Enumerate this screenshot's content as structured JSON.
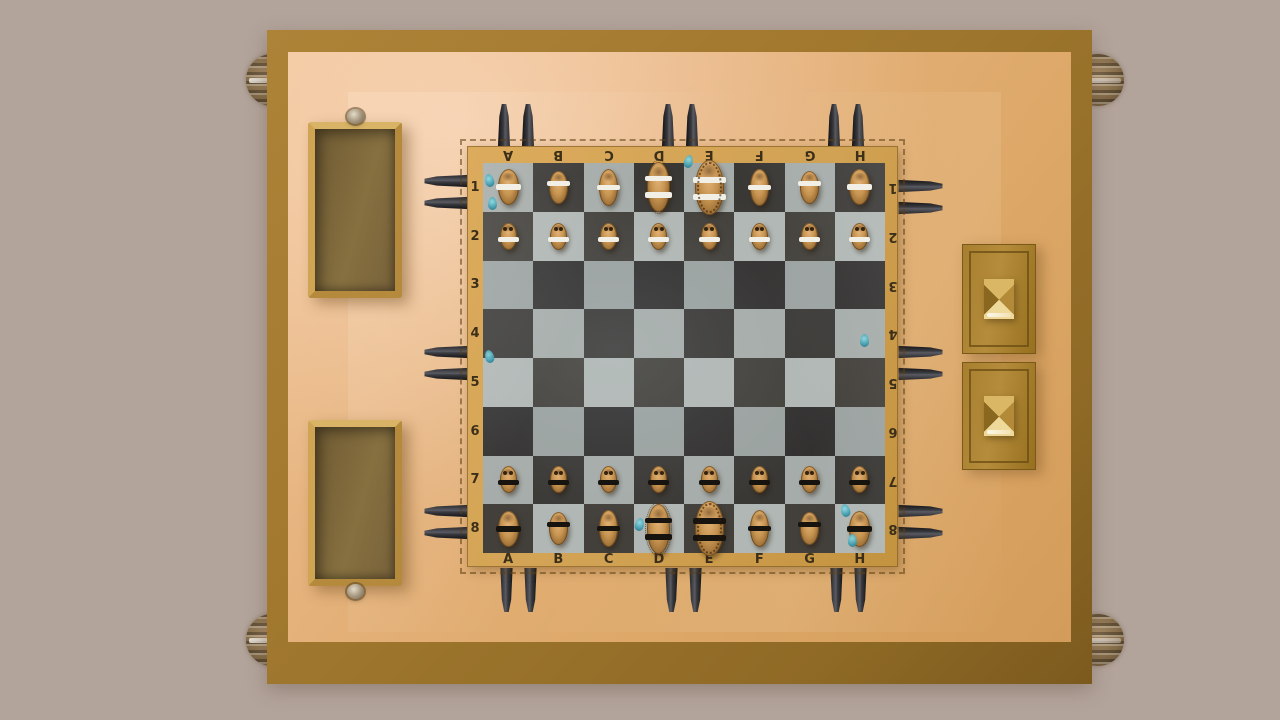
{
  "scene": {
    "background_color": "#b3a49b",
    "table_border_color": "#a1782e",
    "table_surface_color": "#dda868"
  },
  "board": {
    "files": [
      "A",
      "B",
      "C",
      "D",
      "E",
      "F",
      "G",
      "H"
    ],
    "ranks": [
      "1",
      "2",
      "3",
      "4",
      "5",
      "6",
      "7",
      "8"
    ],
    "frame_color": "#d2a254",
    "light_square_color": "#a6aca9",
    "dark_square_color": "#3a3835",
    "label_color": "#3c2f1a"
  },
  "pieces": {
    "wood_color": "#c79551",
    "white_band_color": "#f2efe6",
    "black_band_color": "#17130e",
    "setup": [
      {
        "square": "A1",
        "type": "rook",
        "color": "white"
      },
      {
        "square": "B1",
        "type": "knight",
        "color": "white"
      },
      {
        "square": "C1",
        "type": "bishop",
        "color": "white"
      },
      {
        "square": "D1",
        "type": "queen",
        "color": "white"
      },
      {
        "square": "E1",
        "type": "king",
        "color": "white"
      },
      {
        "square": "F1",
        "type": "bishop",
        "color": "white"
      },
      {
        "square": "G1",
        "type": "knight",
        "color": "white"
      },
      {
        "square": "H1",
        "type": "rook",
        "color": "white"
      },
      {
        "square": "A2",
        "type": "pawn",
        "color": "white"
      },
      {
        "square": "B2",
        "type": "pawn",
        "color": "white"
      },
      {
        "square": "C2",
        "type": "pawn",
        "color": "white"
      },
      {
        "square": "D2",
        "type": "pawn",
        "color": "white"
      },
      {
        "square": "E2",
        "type": "pawn",
        "color": "white"
      },
      {
        "square": "F2",
        "type": "pawn",
        "color": "white"
      },
      {
        "square": "G2",
        "type": "pawn",
        "color": "white"
      },
      {
        "square": "H2",
        "type": "pawn",
        "color": "white"
      },
      {
        "square": "A7",
        "type": "pawn",
        "color": "black"
      },
      {
        "square": "B7",
        "type": "pawn",
        "color": "black"
      },
      {
        "square": "C7",
        "type": "pawn",
        "color": "black"
      },
      {
        "square": "D7",
        "type": "pawn",
        "color": "black"
      },
      {
        "square": "E7",
        "type": "pawn",
        "color": "black"
      },
      {
        "square": "F7",
        "type": "pawn",
        "color": "black"
      },
      {
        "square": "G7",
        "type": "pawn",
        "color": "black"
      },
      {
        "square": "H7",
        "type": "pawn",
        "color": "black"
      },
      {
        "square": "A8",
        "type": "rook",
        "color": "black"
      },
      {
        "square": "B8",
        "type": "knight",
        "color": "black"
      },
      {
        "square": "C8",
        "type": "bishop",
        "color": "black"
      },
      {
        "square": "D8",
        "type": "queen",
        "color": "black"
      },
      {
        "square": "E8",
        "type": "king",
        "color": "black"
      },
      {
        "square": "F8",
        "type": "bishop",
        "color": "black"
      },
      {
        "square": "G8",
        "type": "knight",
        "color": "black"
      },
      {
        "square": "H8",
        "type": "rook",
        "color": "black"
      }
    ]
  },
  "spare_pieces": {
    "color": "#232327",
    "pairs": [
      {
        "edge": "top",
        "center": 516
      },
      {
        "edge": "top",
        "center": 680
      },
      {
        "edge": "top",
        "center": 846
      },
      {
        "edge": "bottom",
        "center": 518
      },
      {
        "edge": "bottom",
        "center": 683
      },
      {
        "edge": "bottom",
        "center": 848
      },
      {
        "edge": "left",
        "center": 192
      },
      {
        "edge": "left",
        "center": 363
      },
      {
        "edge": "left",
        "center": 522
      },
      {
        "edge": "right",
        "center": 197
      },
      {
        "edge": "right",
        "center": 363
      },
      {
        "edge": "right",
        "center": 522
      }
    ]
  },
  "droplets": {
    "color": "#3f9db0",
    "positions": [
      [
        489,
        180
      ],
      [
        492,
        203
      ],
      [
        688,
        161
      ],
      [
        489,
        356
      ],
      [
        864,
        340
      ],
      [
        639,
        524
      ],
      [
        845,
        510
      ],
      [
        852,
        540
      ]
    ]
  },
  "drawers": {
    "left_open": [
      {
        "x": 308,
        "y": 122,
        "w": 94,
        "h": 176,
        "knob": "top"
      },
      {
        "x": 308,
        "y": 420,
        "w": 94,
        "h": 166,
        "knob": "bottom"
      }
    ],
    "right_closed": [
      {
        "x": 962,
        "y": 244,
        "w": 72,
        "h": 108
      },
      {
        "x": 962,
        "y": 362,
        "w": 72,
        "h": 106
      }
    ]
  },
  "corner_knobs": [
    [
      272,
      80
    ],
    [
      1098,
      80
    ],
    [
      272,
      640
    ],
    [
      1098,
      640
    ]
  ]
}
